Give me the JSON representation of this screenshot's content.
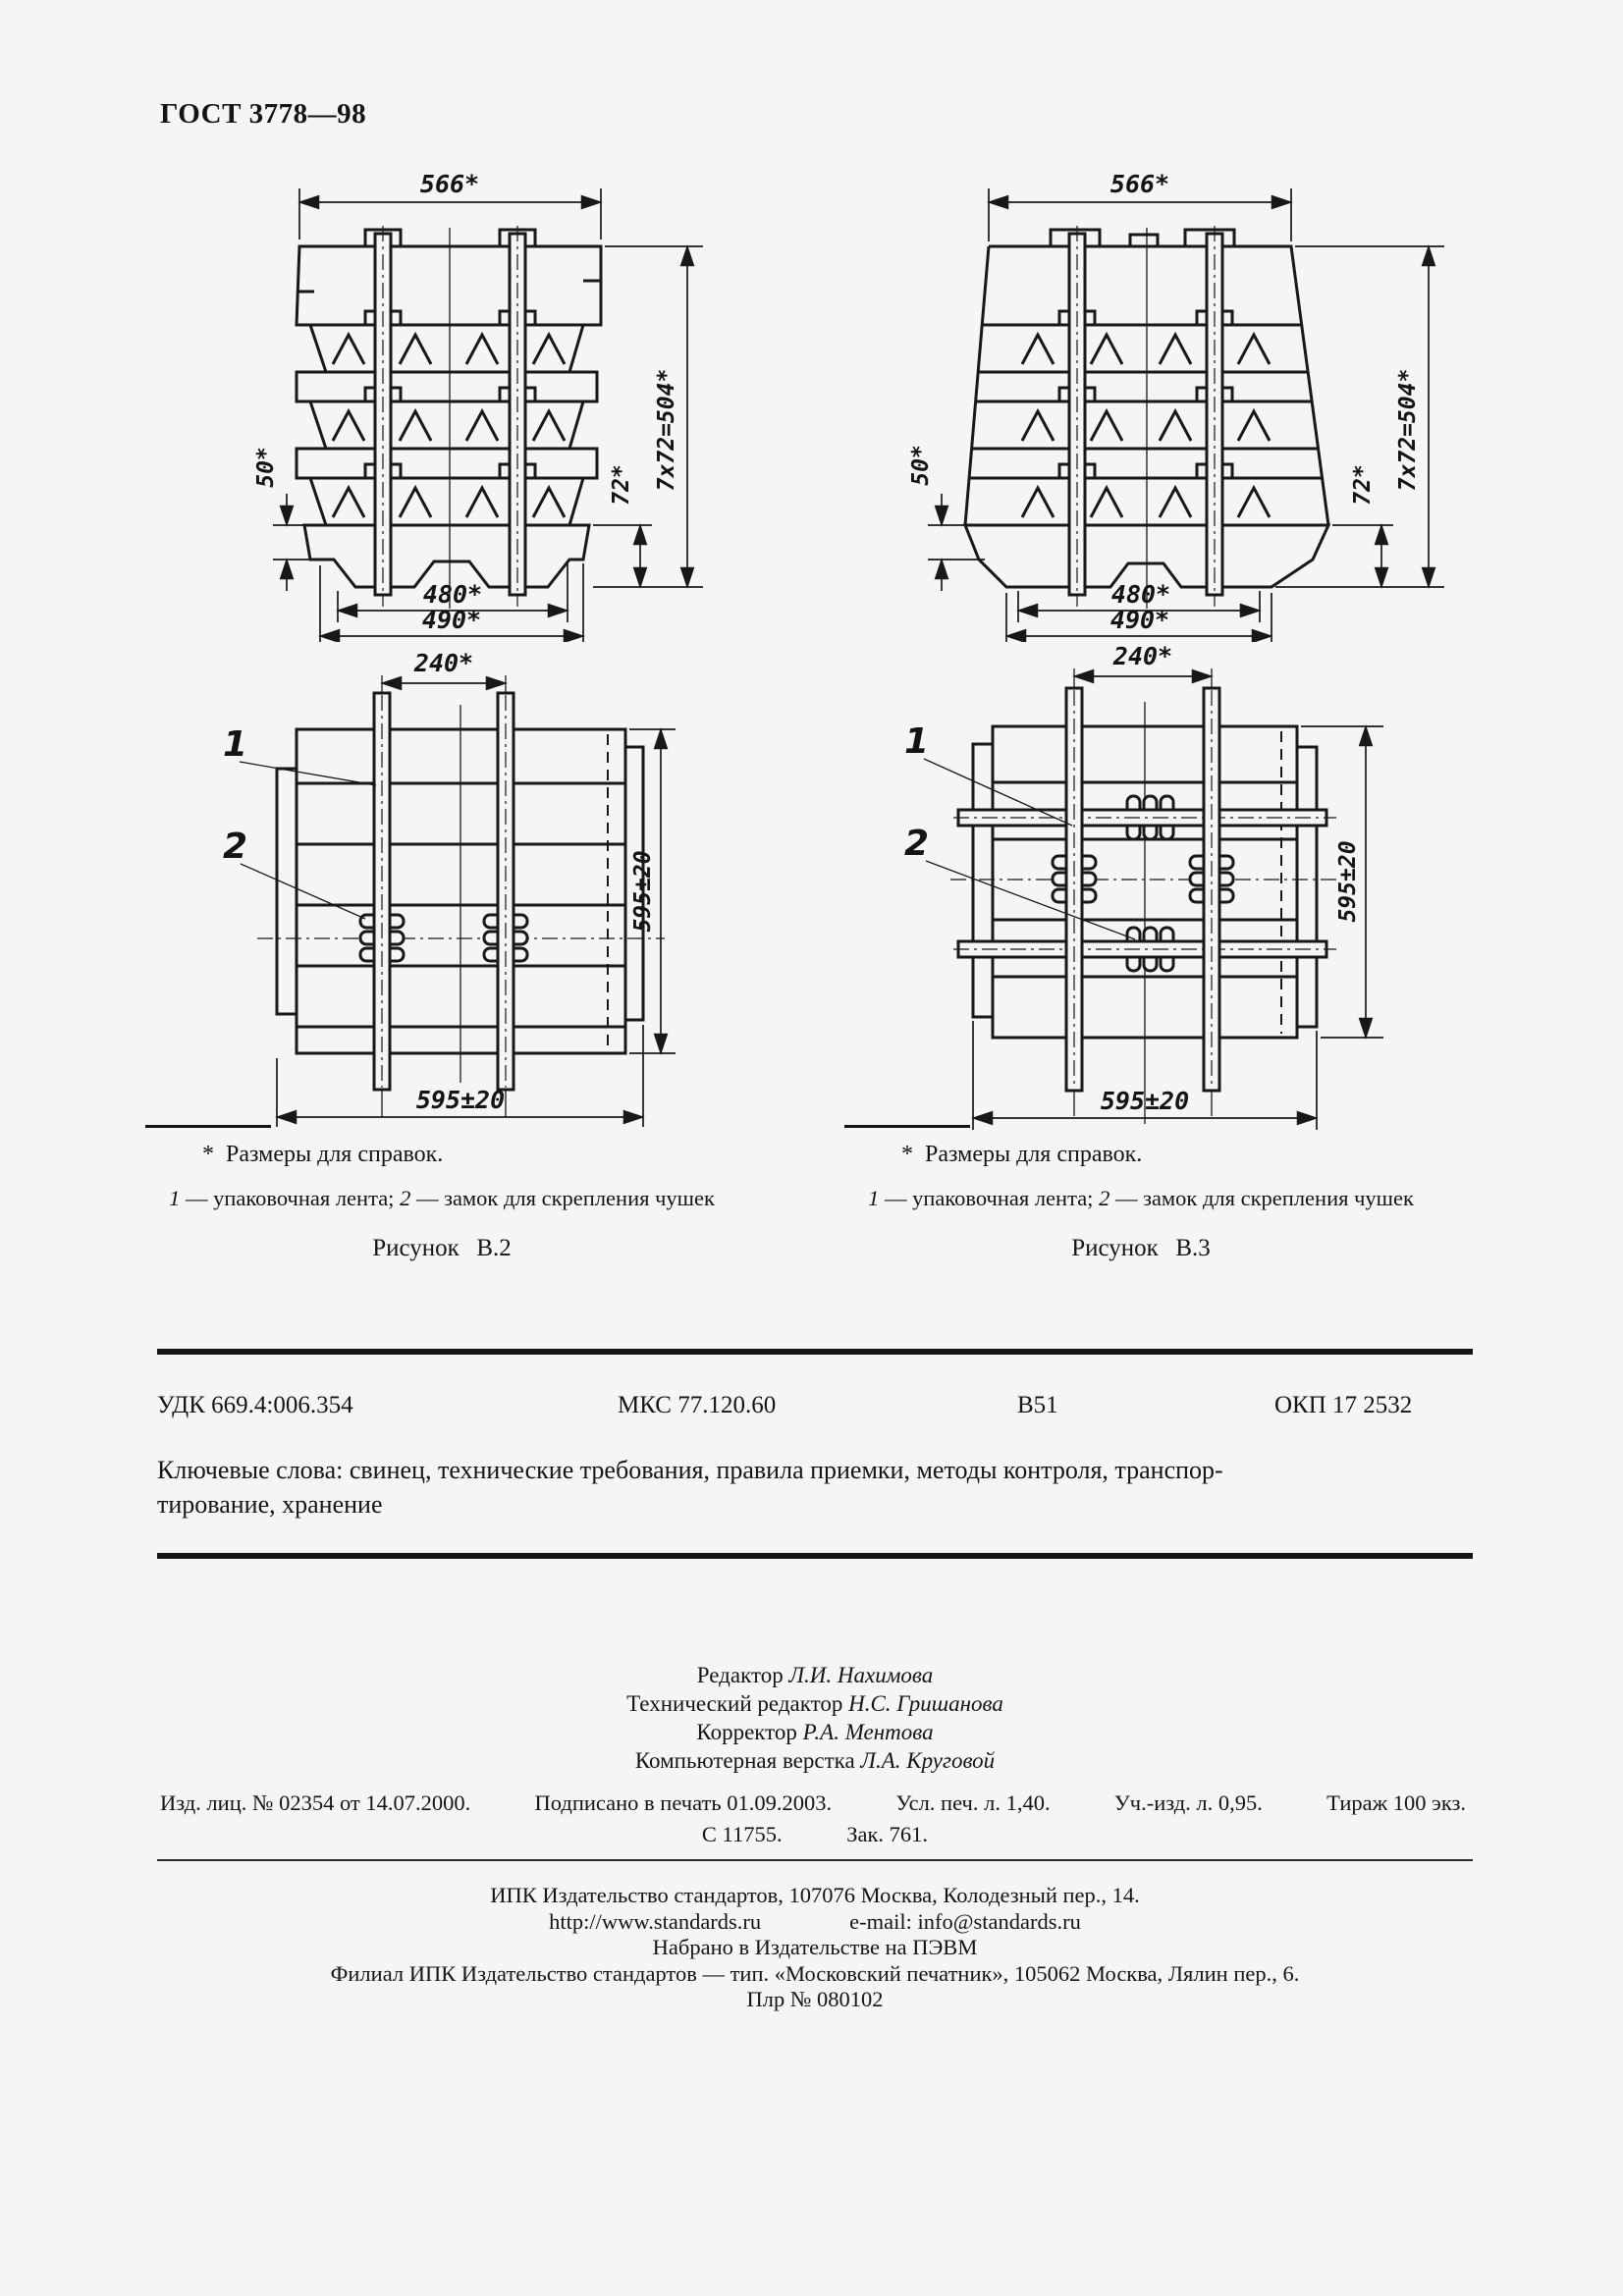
{
  "page": {
    "header": "ГОСТ 3778—98"
  },
  "figures": [
    {
      "caption": "Рисунок В.2",
      "footnote_star": "*",
      "footnote": "Размеры для справок.",
      "legend": {
        "n1": "1",
        "t1": " — упаковочная лента; ",
        "n2": "2",
        "t2": " — замок для скрепления чушек"
      },
      "dims": {
        "width_top": "566*",
        "height_total": "7x72=504*",
        "row": "72*",
        "offset": "50*",
        "inner": "480*",
        "outer": "490*",
        "strap_gap": "240*",
        "plan_width": "595±20",
        "plan_depth": "595±20"
      },
      "callouts": {
        "band": "1",
        "lock": "2"
      }
    },
    {
      "caption": "Рисунок В.3",
      "footnote_star": "*",
      "footnote": "Размеры для справок.",
      "legend": {
        "n1": "1",
        "t1": " — упаковочная лента; ",
        "n2": "2",
        "t2": " — замок для скрепления чушек"
      },
      "dims": {
        "width_top": "566*",
        "height_total": "7x72=504*",
        "row": "72*",
        "offset": "50*",
        "inner": "480*",
        "outer": "490*",
        "strap_gap": "240*",
        "plan_width": "595±20",
        "plan_depth": "595±20"
      },
      "callouts": {
        "band": "1",
        "lock": "2"
      }
    }
  ],
  "classification": {
    "udk": "УДК 669.4:006.354",
    "mks": "МКС 77.120.60",
    "group": "В51",
    "okp": "ОКП 17 2532"
  },
  "keywords": {
    "line1": "Ключевые слова: свинец, технические требования, правила приемки, методы контроля, транспор-",
    "line2": "тирование, хранение"
  },
  "colophon": {
    "editors": [
      {
        "role": "Редактор",
        "name": "Л.И. Нахимова"
      },
      {
        "role": "Технический редактор",
        "name": "Н.С. Гришанова"
      },
      {
        "role": "Корректор",
        "name": "Р.А. Ментова"
      },
      {
        "role": "Компьютерная верстка",
        "name": "Л.А. Круговой"
      }
    ],
    "imprint1": [
      "Изд. лиц. № 02354 от 14.07.2000.",
      "Подписано в печать 01.09.2003.",
      "Усл. печ. л. 1,40.",
      "Уч.-изд. л. 0,95.",
      "Тираж 100 экз."
    ],
    "imprint2": [
      "С 11755.",
      "Зак. 761."
    ],
    "publisher": {
      "line1": "ИПК Издательство стандартов, 107076 Москва, Колодезный пер., 14.",
      "url": "http://www.standards.ru",
      "email": "e-mail: info@standards.ru",
      "line3": "Набрано в Издательстве на ПЭВМ",
      "line4": "Филиал ИПК Издательство стандартов — тип. «Московский печатник», 105062 Москва, Лялин пер., 6.",
      "line5": "Плр № 080102"
    }
  }
}
